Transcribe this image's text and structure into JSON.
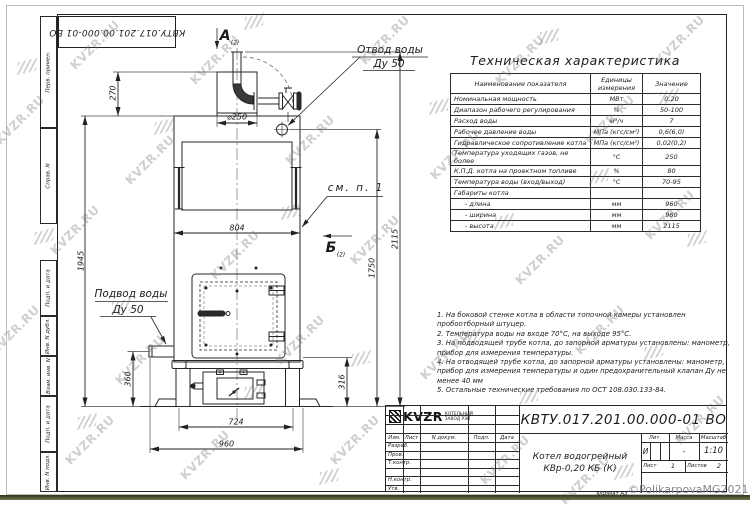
{
  "sheet": {
    "stamp_doc_number": "КВТУ.017.201.00.000-01 ВО",
    "format_label": "Формат А3",
    "copyright": "©PolikarpovaMG2021",
    "watermark_text": "KVZR.RU"
  },
  "side_strip": {
    "labels": [
      "Перв. примен.",
      "Справ. N",
      "Подп. и дата",
      "Инв. N дубл.",
      "Взам. инв. N",
      "Подп. и дата",
      "Инв. N подл."
    ]
  },
  "drawing": {
    "view_a": "А",
    "view_a_sub": "(2)",
    "view_b": "Б",
    "view_b_sub": "(2)",
    "see_note": "см. п. 1",
    "outlet_label_line1": "Отвод воды",
    "outlet_label_line2": "Ду 50",
    "inlet_label_line1": "Подвод воды",
    "inlet_label_line2": "Ду 50",
    "dims": {
      "d270": "270",
      "d250": "⌀250",
      "d804": "804",
      "d1945": "1945",
      "d360": "360",
      "d316": "316",
      "d724": "724",
      "d960": "960",
      "d1750": "1750",
      "d2115": "2115"
    }
  },
  "table": {
    "title": "Техническая характеристика",
    "headers": [
      "Наименование показателя",
      "Единицы измерения",
      "Значение"
    ],
    "rows": [
      [
        "Номинальная мощность",
        "МВт",
        "0,20"
      ],
      [
        "Диапазон рабочего регулирования",
        "%",
        "50-100"
      ],
      [
        "Расход воды",
        "м³/ч",
        "7"
      ],
      [
        "Рабочее давление воды",
        "МПа (кгс/см²)",
        "0,6(6,0)"
      ],
      [
        "Гидравлическое сопротивление котла",
        "МПа (кгс/см²)",
        "0,02(0,2)"
      ],
      [
        "Температура уходящих газов, не более",
        "°С",
        "250"
      ],
      [
        "К.П.Д. котла на проектном топливе",
        "%",
        "80"
      ],
      [
        "Температура воды (вход/выход)",
        "°С",
        "70-95"
      ],
      [
        "Габариты котла",
        "",
        ""
      ],
      [
        "- длина",
        "мм",
        "960"
      ],
      [
        "- ширина",
        "мм",
        "960"
      ],
      [
        "- высота",
        "мм",
        "2115"
      ]
    ]
  },
  "notes": [
    "1. На боковой стенке котла в области топочной камеры установлен пробоотборный штуцер.",
    "2. Температура воды на входе 70°С, на выходе 95°С.",
    "3. На подводящей трубе котла, до запорной арматуры установлены: манометр, прибор для измерения температуры.",
    "4. На отводящей трубе котла, до запорной арматуры установлены: манометр, прибор для измерения температуры и один предохранительный клапан Ду не менее 40 мм",
    "5. Остальные технические требования по ОСТ 108.030.133-84."
  ],
  "title_block": {
    "doc_number": "КВТУ.017.201.00.000-01 ВО",
    "name_line1": "Котел водогрейный",
    "name_line2": "КВр-0,20 КБ (К)",
    "col_headers": [
      "Изм.",
      "Лист",
      "N докум.",
      "Подп.",
      "Дата"
    ],
    "sign_rows": [
      "Разраб.",
      "Пров.",
      "Т.контр.",
      "",
      "Н.контр.",
      "Утв."
    ],
    "lit_label": "Лит.",
    "mass_label": "Масса",
    "scale_label": "Масштаб",
    "lit_value": "И",
    "mass_value": "-",
    "scale_value": "1:10",
    "sheet_label": "Лист",
    "sheet_value": "1",
    "sheets_label": "Листов",
    "sheets_value": "2",
    "logo_text": "KVZR",
    "logo_sub1": "КОТЕЛЬНЫЙ",
    "logo_sub2": "ЗАВОД РЭП"
  }
}
